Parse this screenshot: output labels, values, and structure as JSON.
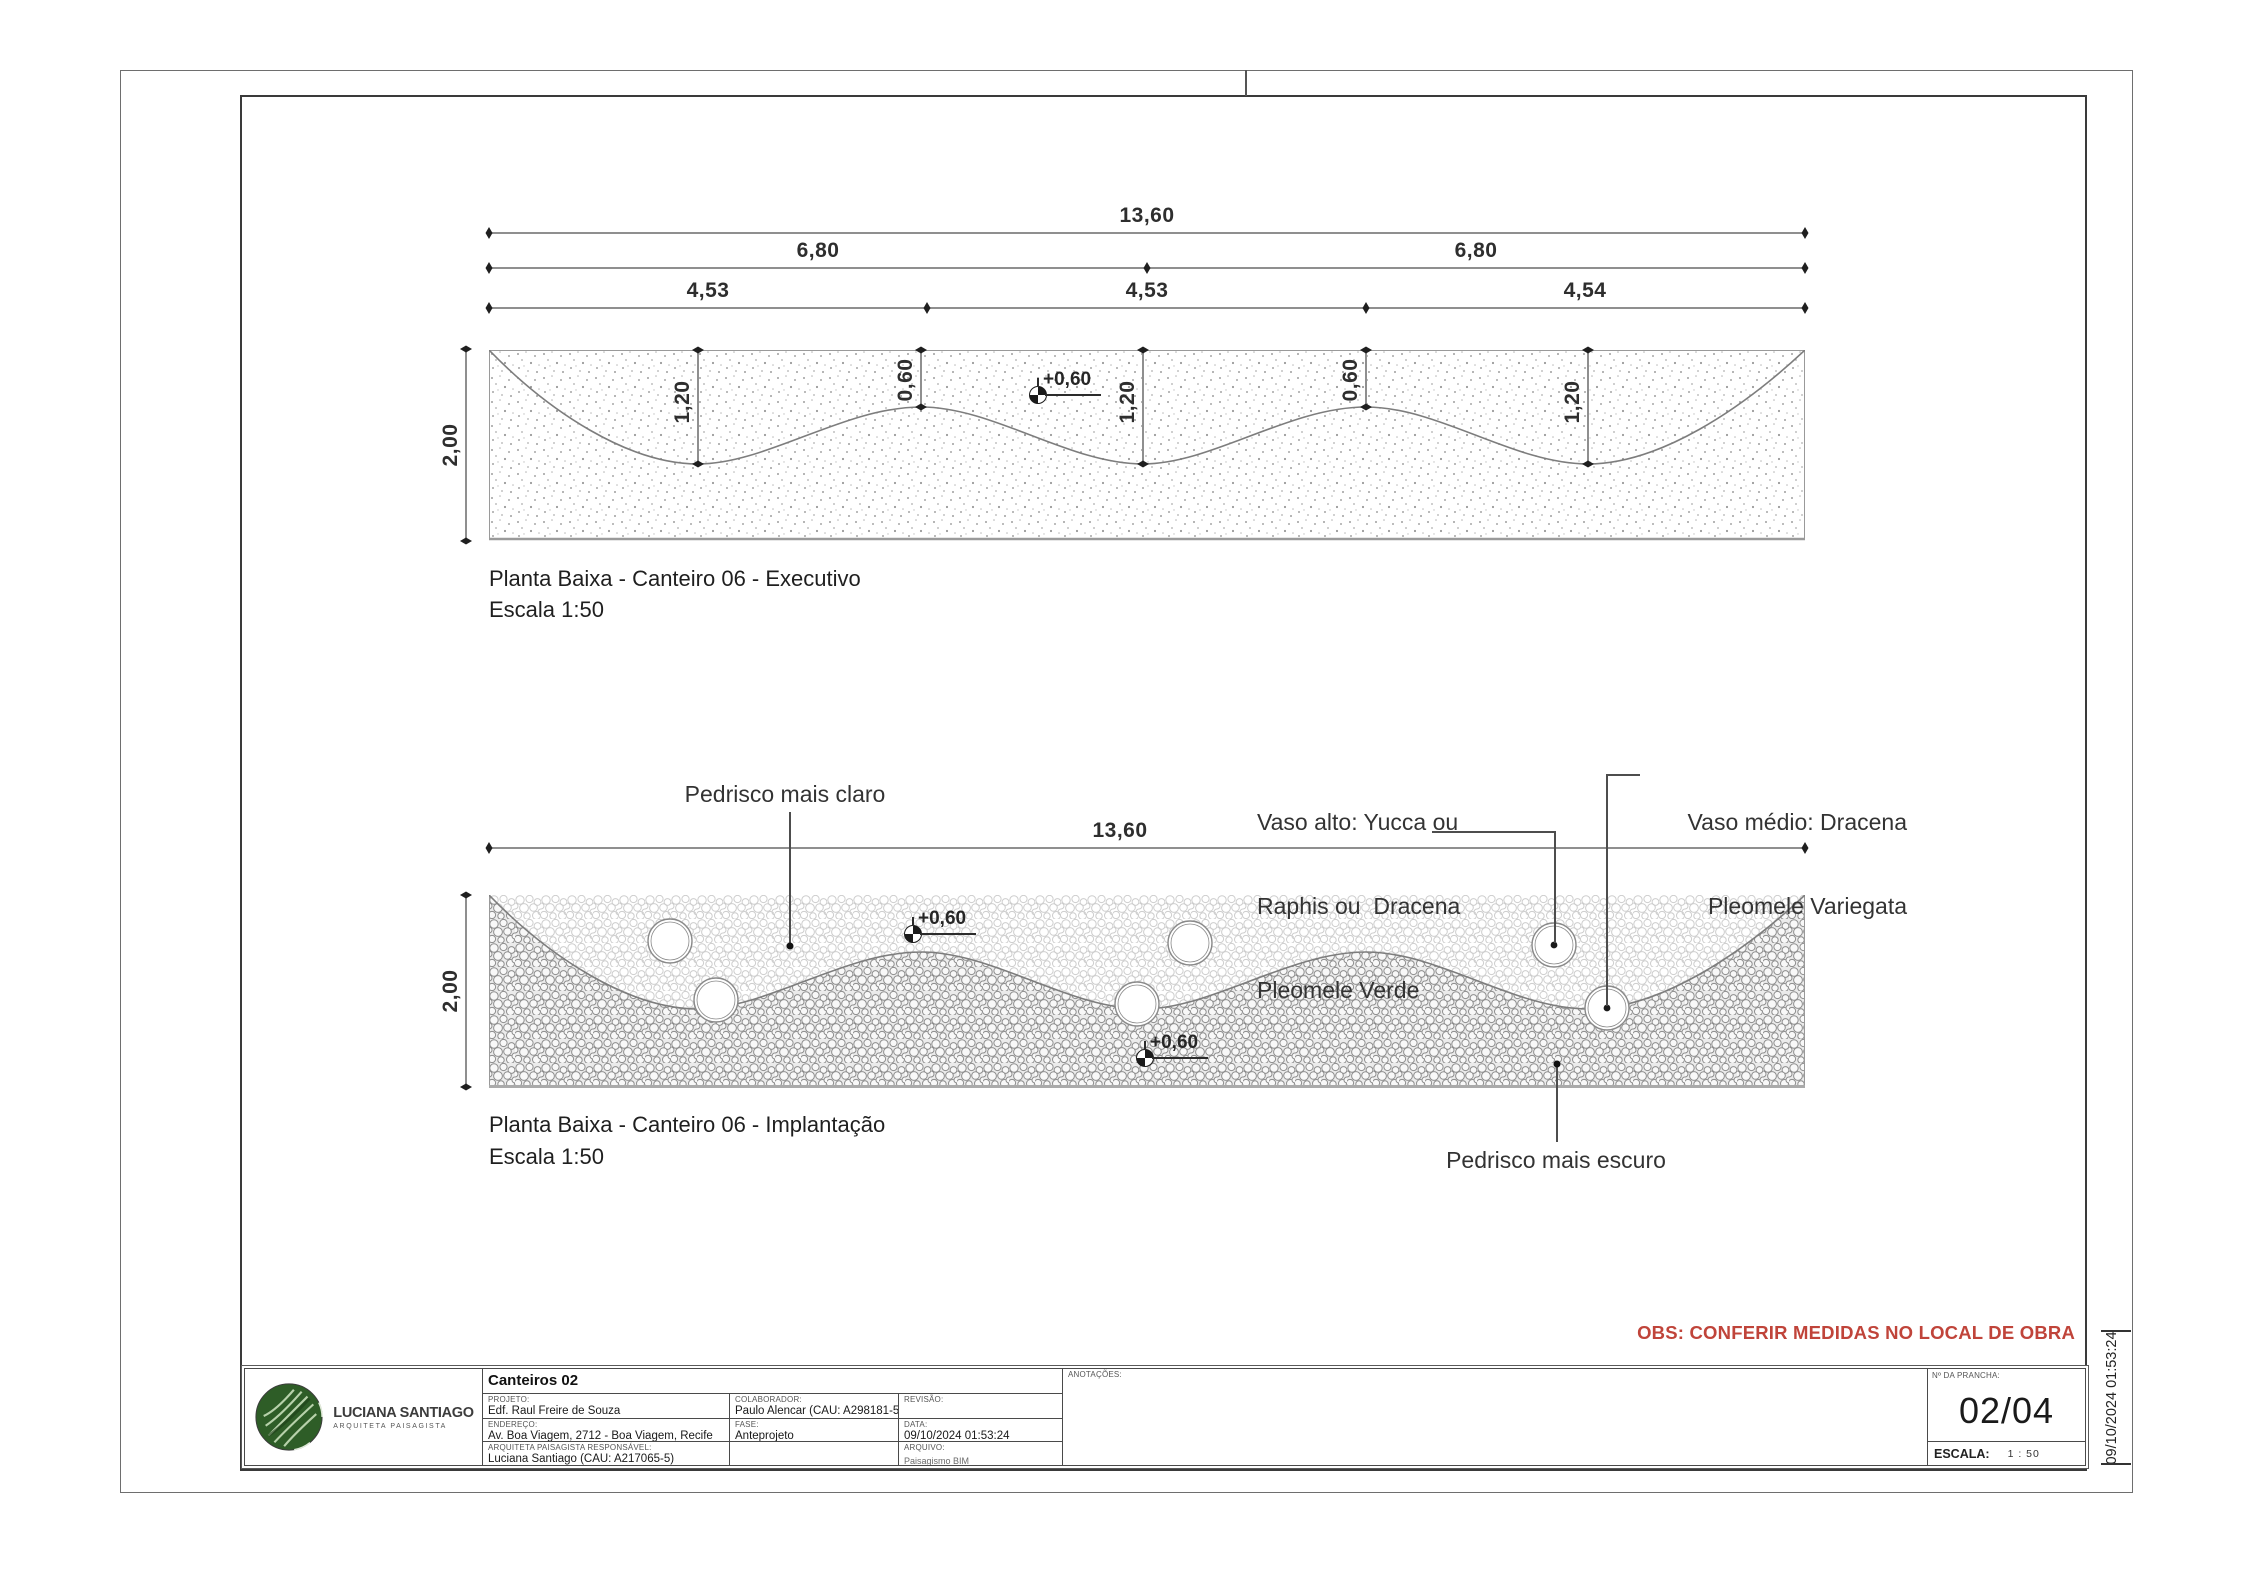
{
  "frame": {
    "obs": "OBS: CONFERIR MEDIDAS NO LOCAL DE OBRA",
    "obs_color": "#c0443a",
    "side_note": "09/10/2024 01:53:24"
  },
  "top_drawing": {
    "title": "Planta Baixa - Canteiro 06 - Executivo",
    "scale": "Escala 1:50",
    "dim_total": "13,60",
    "dim_halves": [
      "6,80",
      "6,80"
    ],
    "dim_thirds": [
      "4,53",
      "4,53",
      "4,54"
    ],
    "dim_height": "2,00",
    "dim_troughs": [
      "1,20",
      "1,20",
      "1,20"
    ],
    "dim_crests": [
      "0,60",
      "0,60"
    ],
    "level": "+0,60"
  },
  "bottom_drawing": {
    "title": "Planta Baixa - Canteiro 06 - Implantação",
    "scale": "Escala 1:50",
    "dim_total": "13,60",
    "dim_height": "2,00",
    "level_top": "+0,60",
    "level_bottom": "+0,60",
    "label_light_gravel": "Pedrisco mais claro",
    "label_dark_gravel": "Pedrisco mais escuro",
    "label_tall_vase": [
      "Vaso alto: Yucca ou",
      "Raphis ou  Dracena",
      "Pleomele Verde"
    ],
    "label_medium_vase": [
      "Vaso médio: Dracena",
      "Pleomele Variegata"
    ]
  },
  "title_block": {
    "logo_name": "LUCIANA SANTIAGO",
    "logo_subtitle": "ARQUITETA PAISAGISTA",
    "logo_green": "#2e5d27",
    "sheet_title": "Canteiros 02",
    "projeto_label": "PROJETO:",
    "projeto": "Edf. Raul Freire de Souza",
    "colaborador_label": "COLABORADOR:",
    "colaborador": "Paulo Alencar (CAU: A298181-5)",
    "revisao_label": "REVISÃO:",
    "endereco_label": "ENDEREÇO:",
    "endereco": "Av. Boa Viagem, 2712 - Boa Viagem, Recife",
    "fase_label": "FASE:",
    "fase": "Anteprojeto",
    "data_label": "DATA:",
    "data": "09/10/2024 01:53:24",
    "responsavel_label": "ARQUITETA PAISAGISTA RESPONSÁVEL:",
    "responsavel": "Luciana Santiago (CAU: A217065-5)",
    "arquivo_label": "ARQUIVO:",
    "arquivo": "Paisagismo BIM",
    "anotacoes_label": "ANOTAÇÕES:",
    "prancha_label": "Nº DA PRANCHA:",
    "prancha": "02/04",
    "escala_label": "ESCALA:",
    "escala": "1 : 50"
  }
}
